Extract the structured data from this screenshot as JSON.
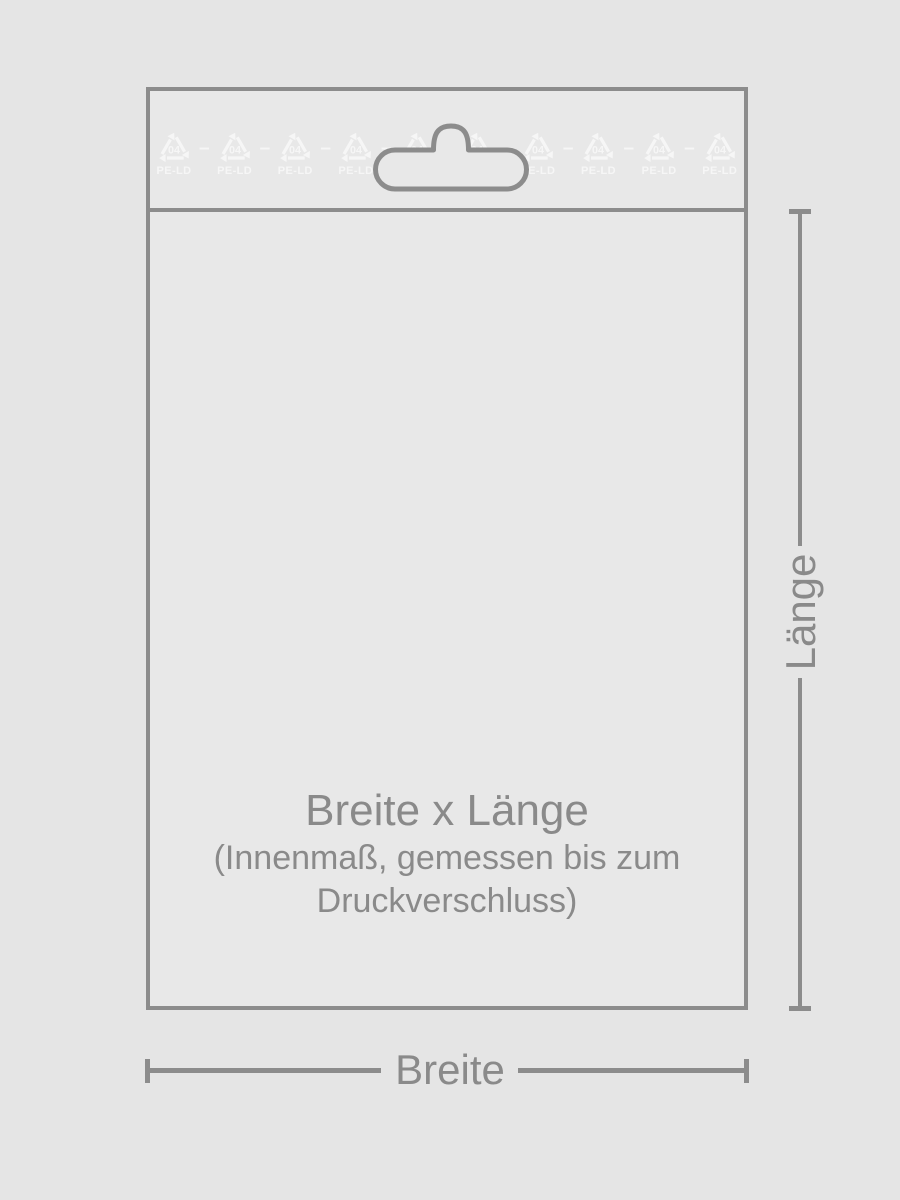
{
  "colors": {
    "bg": "#e5e5e5",
    "bag": "#e8e8e8",
    "line": "#8c8c8c",
    "text": "#8a8a8a",
    "symbol": "#f6f6f6"
  },
  "bag": {
    "size_title": "Breite x Länge",
    "size_note_line1": "(Innenmaß, gemessen bis zum",
    "size_note_line2": "Druckverschluss)"
  },
  "recycle_row": {
    "count": 10,
    "resin_code": "04",
    "material": "PE-LD",
    "separator": "–"
  },
  "dimension_labels": {
    "length": "Länge",
    "width": "Breite"
  }
}
